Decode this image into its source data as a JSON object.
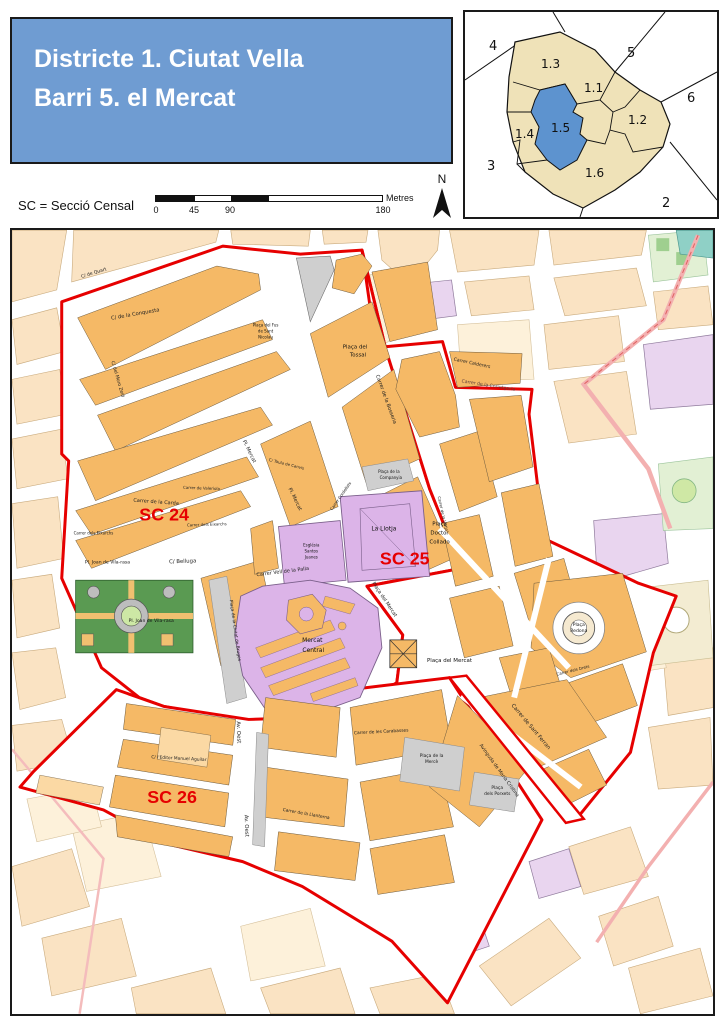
{
  "header": {
    "line1": "Districte 1. Ciutat Vella",
    "line2": "Barri 5. el Mercat",
    "bg_color": "#6f9cd2"
  },
  "legend": {
    "sc_note": "SC = Secció Censal",
    "unit": "Metres",
    "ticks": [
      "0",
      "45",
      "90",
      "180"
    ],
    "north": "N"
  },
  "inset": {
    "highlight_color": "#5d93cf",
    "district_color": "#efe2b8",
    "outside": {
      "d2": "2",
      "d3": "3",
      "d4": "4",
      "d5": "5",
      "d6": "6"
    },
    "sections": {
      "s11": "1.1",
      "s12": "1.2",
      "s13": "1.3",
      "s14": "1.4",
      "s15": "1.5",
      "s16": "1.6"
    }
  },
  "map": {
    "boundary_color": "#e60000",
    "building_color": "#f5b966",
    "landmark_color": "#dcb4e8",
    "sc_labels": {
      "sc24": "SC 24",
      "sc25": "SC 25",
      "sc26": "SC 26"
    },
    "streets": {
      "quart": "C/ de Quart",
      "conquesta": "C/ de la Conquesta",
      "moro_zeid": "C/ del Moro Zeid",
      "bosseria": "Carrer de la Bosseria",
      "calderers": "Carrer Calderers",
      "carda": "Carrer de la Carda",
      "valeriola": "Carrer de Valeriola",
      "eixarchs": "Carrer dels Eixarchs",
      "eixarchs2": "Carrer dels Eixarchs",
      "belluga": "C/ Belluga",
      "pl_mercat": "Pl. Mercat",
      "pl_mercat2": "Pl. Mercat",
      "taula_canvis": "C/ Taula de Canvis",
      "cordellats": "Carrer Cordellats",
      "llotja_st": "Carrer de la Llotja",
      "corretgeria": "Carrer de la Corretgeria",
      "vell_palla": "Carrer Vell de la Palla",
      "ciutat_bruges": "Plaça de la Ciutat de Bruges",
      "placa_mercat_st": "Plaça del Mercat",
      "sant_ferran": "Carrer de Sant Ferran",
      "drets": "Carrer dels Drets",
      "carabasses": "Carrer de les Carabasses",
      "maria_cristina": "Avinguda de Maria Cristina",
      "editor_aguilar": "C/ l'Editor Manuel Aguilar",
      "av_oest": "Av. Oest",
      "av_oest2": "Av. Oest",
      "llanterna": "Carrer de la Llanterna"
    },
    "places": {
      "tossal": {
        "l1": "Plaça del",
        "l2": "Tossal"
      },
      "sant_nicolau": {
        "l1": "Plaça del Fus",
        "l2": "de Sant",
        "l3": "Nicolau"
      },
      "vilarasa": "Pl. Joan de Vila-rasa",
      "vilarasa2": "Pl. Joan de Vila-rasa",
      "companyia": {
        "l1": "Plaça de la",
        "l2": "Companyia"
      },
      "la_llotja": "La Llotja",
      "collado": {
        "l1": "Plaça",
        "l2": "Doctor",
        "l3": "Collado"
      },
      "esglesia": {
        "l1": "Església",
        "l2": "Santos",
        "l3": "Juanes"
      },
      "mercat_central": {
        "l1": "Mercat",
        "l2": "Central"
      },
      "placa_mercat": {
        "l1": "Plaça del Mercat"
      },
      "redona": {
        "l1": "Plaça",
        "l2": "Redona"
      },
      "merce": {
        "l1": "Plaça de la",
        "l2": "Mercè"
      },
      "porxets": {
        "l1": "Plaça",
        "l2": "dels Porxets"
      }
    }
  }
}
